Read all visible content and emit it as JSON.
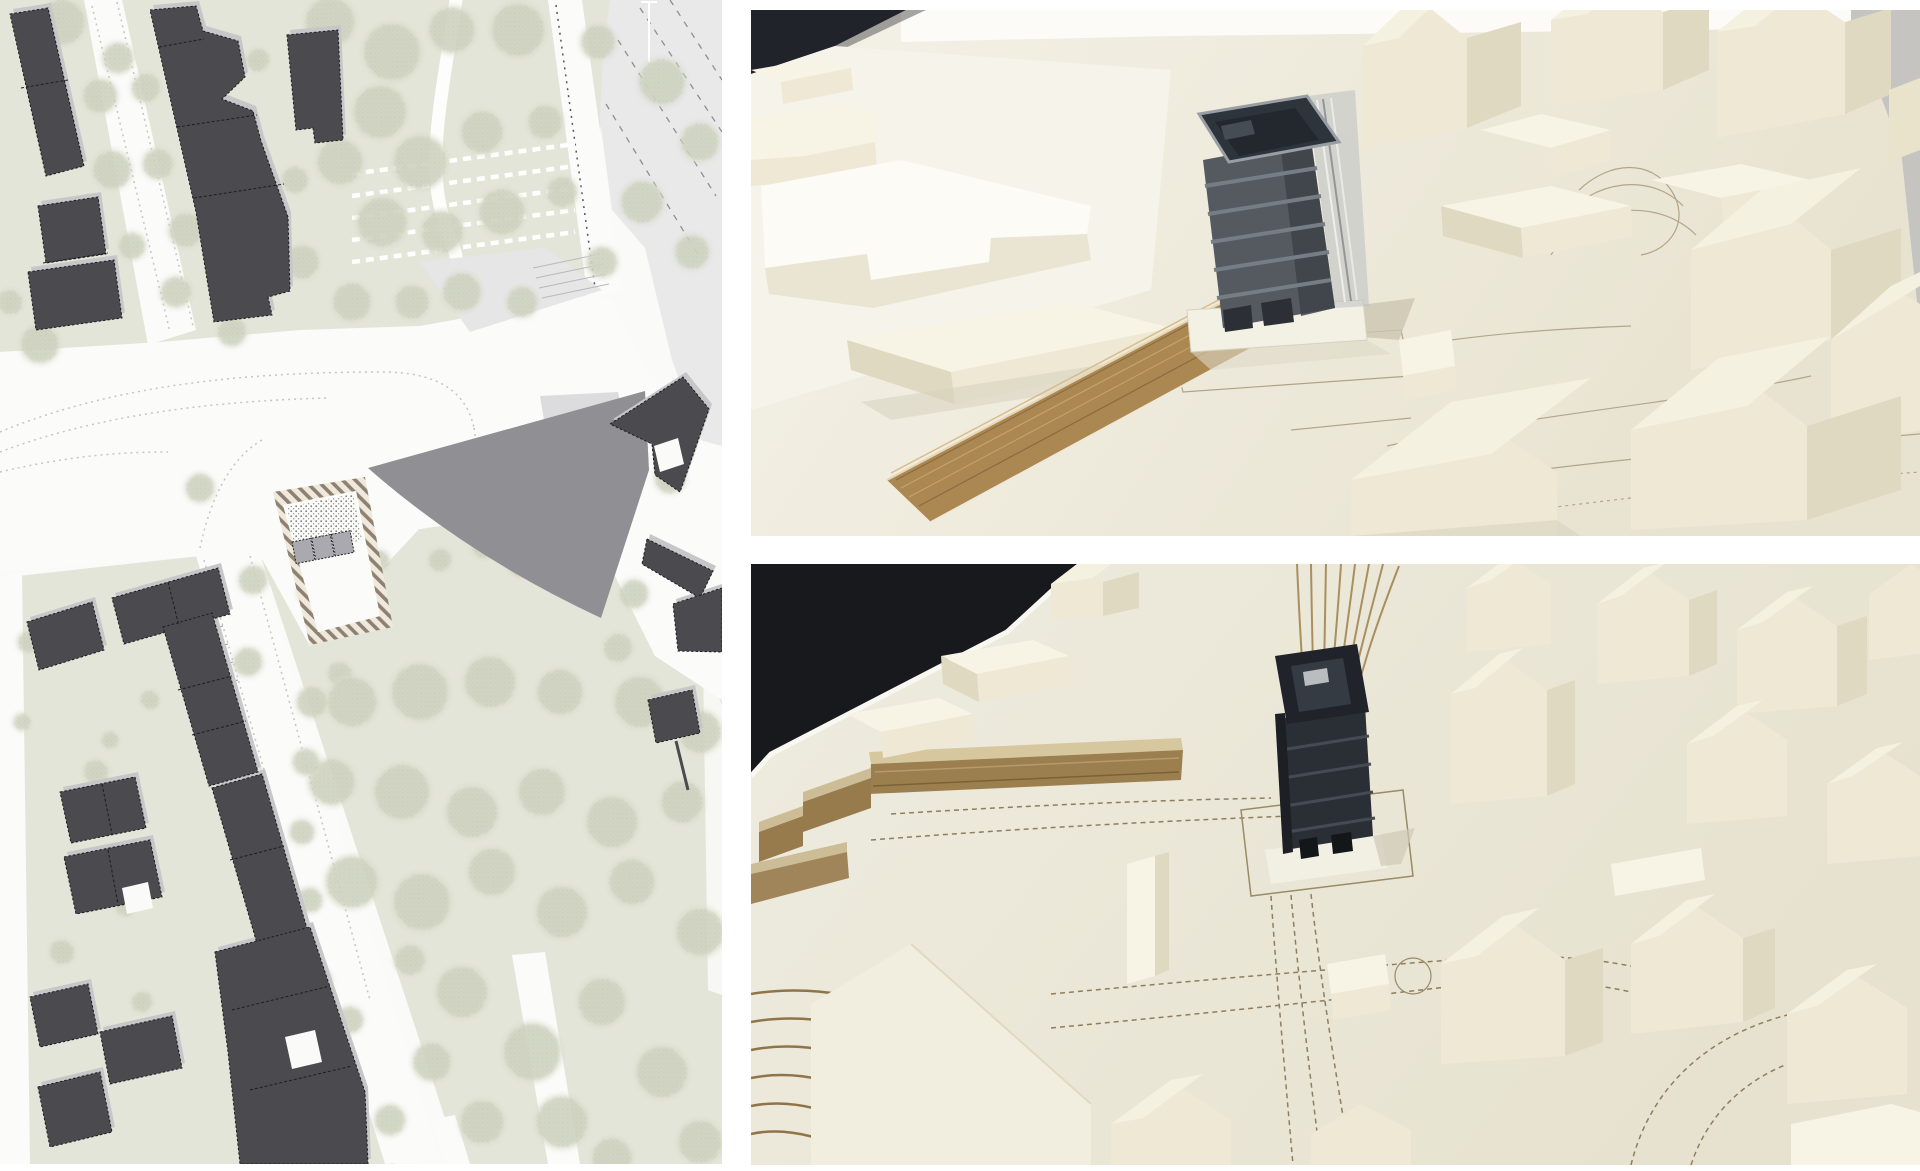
{
  "page": {
    "title": "Architecture presentation collage: site plan and physical model photos",
    "background_color": "#ffffff"
  },
  "panels": {
    "site_plan": {
      "label": "Site plan drawing with dark building footprints, green spaces, streets and hatched project site",
      "colors": {
        "ground": "#e4e5d9",
        "buildings": "#4a4a4f",
        "building_shadow": "#c7c7c9",
        "roads": "#fbfbfa",
        "main_road": "#e9e9ea",
        "tree_base": "#d8dbc9",
        "tree_speckle": "#99a089",
        "site_hatch": "#8f8170",
        "site_units": "#a9a9af",
        "shadow_wedge": "#8f8f94"
      },
      "trees": [
        [
          62,
          22,
          24
        ],
        [
          118,
          58,
          16
        ],
        [
          100,
          96,
          18
        ],
        [
          146,
          88,
          15
        ],
        [
          112,
          170,
          20
        ],
        [
          158,
          164,
          16
        ],
        [
          186,
          230,
          18
        ],
        [
          132,
          246,
          14
        ],
        [
          176,
          292,
          16
        ],
        [
          40,
          344,
          20
        ],
        [
          10,
          302,
          13
        ],
        [
          232,
          332,
          15
        ],
        [
          250,
          210,
          12
        ],
        [
          240,
          130,
          12
        ],
        [
          258,
          60,
          12
        ],
        [
          330,
          22,
          26
        ],
        [
          392,
          52,
          30
        ],
        [
          452,
          30,
          24
        ],
        [
          518,
          30,
          28
        ],
        [
          598,
          42,
          18
        ],
        [
          662,
          82,
          24
        ],
        [
          700,
          142,
          20
        ],
        [
          380,
          112,
          28
        ],
        [
          340,
          162,
          24
        ],
        [
          420,
          162,
          28
        ],
        [
          482,
          132,
          22
        ],
        [
          545,
          122,
          18
        ],
        [
          382,
          222,
          26
        ],
        [
          442,
          232,
          22
        ],
        [
          302,
          262,
          18
        ],
        [
          352,
          302,
          20
        ],
        [
          502,
          212,
          24
        ],
        [
          562,
          192,
          16
        ],
        [
          642,
          202,
          22
        ],
        [
          692,
          252,
          18
        ],
        [
          602,
          262,
          16
        ],
        [
          462,
          292,
          20
        ],
        [
          522,
          302,
          16
        ],
        [
          412,
          302,
          18
        ],
        [
          295,
          180,
          14
        ],
        [
          270,
          240,
          12
        ],
        [
          200,
          488,
          15
        ],
        [
          253,
          580,
          15
        ],
        [
          310,
          592,
          13
        ],
        [
          248,
          662,
          15
        ],
        [
          340,
          674,
          13
        ],
        [
          560,
          474,
          18
        ],
        [
          670,
          478,
          16
        ],
        [
          584,
          538,
          15
        ],
        [
          564,
          578,
          13
        ],
        [
          634,
          594,
          15
        ],
        [
          618,
          648,
          15
        ],
        [
          522,
          562,
          16
        ],
        [
          484,
          546,
          13
        ],
        [
          440,
          560,
          12
        ],
        [
          380,
          560,
          10
        ],
        [
          352,
          702,
          26
        ],
        [
          420,
          692,
          30
        ],
        [
          490,
          682,
          27
        ],
        [
          560,
          692,
          24
        ],
        [
          640,
          702,
          27
        ],
        [
          700,
          732,
          22
        ],
        [
          332,
          782,
          24
        ],
        [
          402,
          792,
          29
        ],
        [
          472,
          812,
          27
        ],
        [
          542,
          792,
          25
        ],
        [
          612,
          822,
          27
        ],
        [
          682,
          802,
          22
        ],
        [
          352,
          882,
          27
        ],
        [
          422,
          902,
          30
        ],
        [
          492,
          872,
          25
        ],
        [
          562,
          912,
          27
        ],
        [
          632,
          882,
          24
        ],
        [
          700,
          932,
          25
        ],
        [
          462,
          992,
          27
        ],
        [
          532,
          1052,
          30
        ],
        [
          602,
          1002,
          25
        ],
        [
          662,
          1072,
          27
        ],
        [
          700,
          1142,
          23
        ],
        [
          562,
          1122,
          27
        ],
        [
          482,
          1122,
          23
        ],
        [
          612,
          1158,
          21
        ],
        [
          432,
          1062,
          20
        ],
        [
          312,
          702,
          16
        ],
        [
          306,
          762,
          14
        ],
        [
          302,
          832,
          13
        ],
        [
          310,
          900,
          13
        ],
        [
          320,
          980,
          12
        ],
        [
          410,
          960,
          16
        ],
        [
          390,
          1120,
          16
        ],
        [
          350,
          1020,
          14
        ],
        [
          96,
          772,
          13
        ],
        [
          126,
          906,
          11
        ],
        [
          62,
          952,
          13
        ],
        [
          142,
          1002,
          11
        ],
        [
          200,
          622,
          9
        ],
        [
          28,
          642,
          11
        ],
        [
          22,
          722,
          9
        ],
        [
          150,
          700,
          10
        ],
        [
          110,
          740,
          9
        ]
      ]
    },
    "model_photo_top": {
      "label": "Photo of physical architecture model, eye-level perspective: dark scheme building with plywood ramp among white foam houses",
      "colors": {
        "board": "#ece7d6",
        "foam_buildings": "#f3eedb",
        "dark_building": "#2e343b",
        "plywood_ramp": "#ab8752",
        "table_background": "#c5c4c1",
        "dark_backdrop": "#202329"
      }
    },
    "model_photo_bottom": {
      "label": "Photo of physical architecture model, aerial view: dark scheme building, plywood terraces and white foam town",
      "colors": {
        "board": "#e9e4d2",
        "foam_buildings": "#f2eedf",
        "dark_building": "#23272c",
        "plywood_terraces": "#9b7f4f",
        "drawn_roads": "#8f7e5e",
        "dark_backdrop": "#17191d"
      }
    }
  }
}
